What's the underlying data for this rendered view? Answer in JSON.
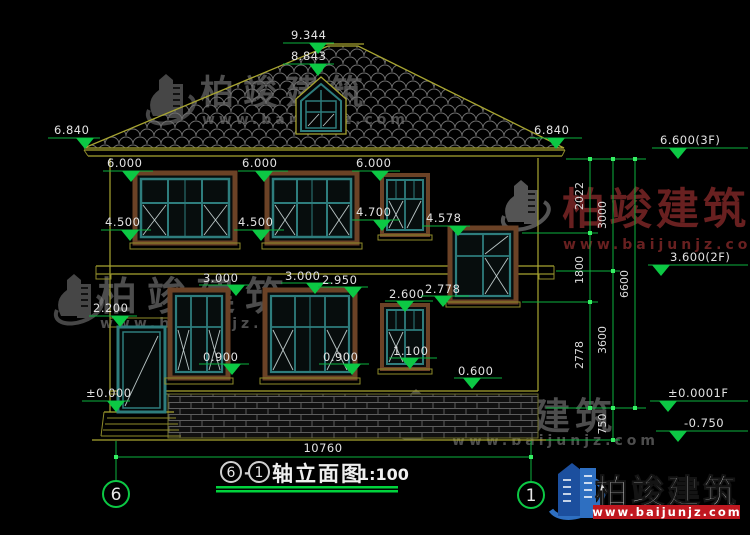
{
  "title_block": {
    "axis_from": "6",
    "separator": "-",
    "axis_to": "1",
    "name": "轴立面图",
    "scale": "1:100"
  },
  "grid_bubbles": {
    "left": "6",
    "right": "1"
  },
  "dimensions": {
    "total_width": "10760",
    "vertical_segments": {
      "s2022": "2022",
      "s1800": "1800",
      "s2778": "2778",
      "s3000": "3000",
      "s3600": "3600",
      "s750": "750",
      "s6600": "6600"
    }
  },
  "levels": {
    "ridge": "9.344",
    "dormer": "8.843",
    "eave": "6.840",
    "floor3": "6.600(3F)",
    "floor2": "3.600(2F)",
    "win2f_head": "6.000",
    "win2f_sill": "4.500",
    "win2f_sill_small": "4.700",
    "stair_head": "4.578",
    "win1f_head": "3.000",
    "win1f_head_b": "2.950",
    "stair_sill": "2.778",
    "small_head": "2.600",
    "door_head": "2.200",
    "win1f_sill": "0.900",
    "small_sill": "1.100",
    "plinth": "0.600",
    "ground": "±0.000",
    "ground_1f": "±0.0001F",
    "site": "-0.750"
  },
  "watermarks": {
    "brand": "柏竣建筑",
    "url": "www.baijunjz.com"
  },
  "logo": {
    "brand": "柏竣建筑",
    "url": "www.baijunjz.com"
  },
  "colors": {
    "dim_green": "#0cc844",
    "structure_yellow": "#a8a531",
    "frame_teal": "#2e7d7d",
    "frame_brown": "#6b4226",
    "logo_blue": "#2e6fc1",
    "logo_red": "#c01820"
  }
}
